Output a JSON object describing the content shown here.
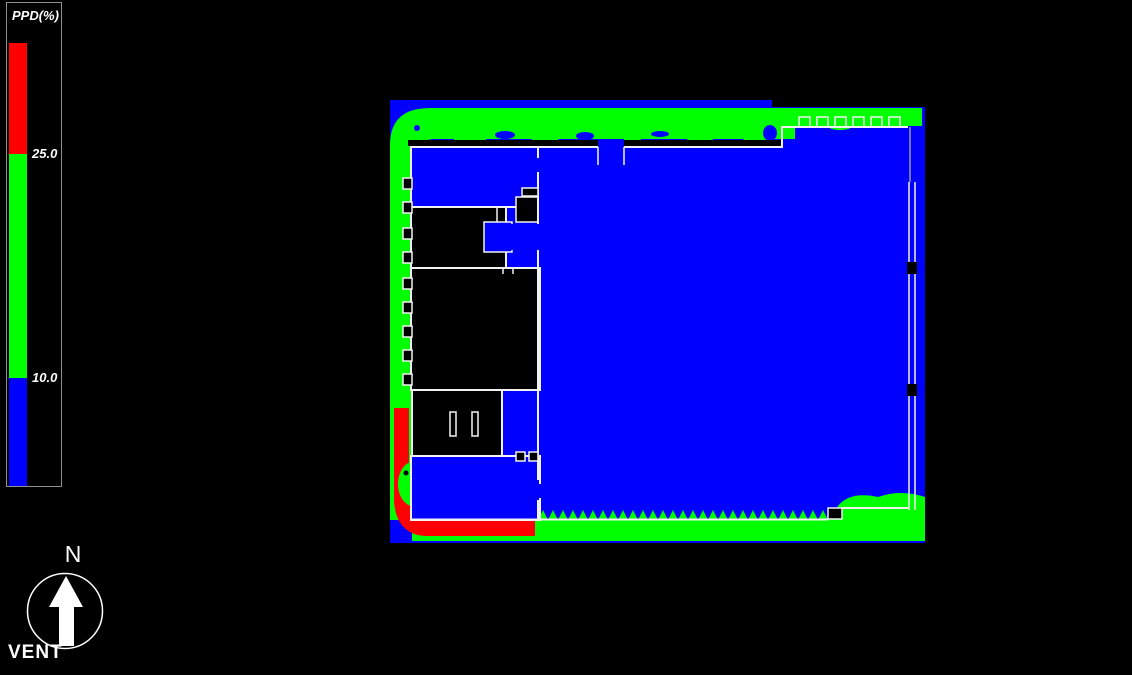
{
  "app": {
    "background_color": "#000000"
  },
  "legend": {
    "title": "PPD(%)",
    "units": "%",
    "ticks": [
      {
        "value": "25.0"
      },
      {
        "value": "10.0"
      }
    ],
    "bands": [
      {
        "name": "high",
        "color": "#ff0000",
        "range": "> 25.0"
      },
      {
        "name": "mid",
        "color": "#00ff00",
        "range": "10.0 - 25.0"
      },
      {
        "name": "low",
        "color": "#0000ff",
        "range": "< 10.0"
      }
    ]
  },
  "compass": {
    "north_label": "N",
    "caption": "VENT"
  },
  "chart_data": {
    "type": "heatmap",
    "title": "PPD(%)",
    "subtitle": "Predicted Percentage Dissatisfied contour map over building floor plan",
    "units": "%",
    "thresholds": [
      10.0,
      25.0
    ],
    "legend_entries": [
      {
        "color": "#ff0000",
        "range": "> 25.0"
      },
      {
        "color": "#00ff00",
        "range": "10.0 - 25.0"
      },
      {
        "color": "#0000ff",
        "range": "< 10.0"
      }
    ],
    "zones": [
      {
        "area": "main open interior space (east/centre)",
        "ppd": "< 10 (blue)"
      },
      {
        "area": "perimeter band along north wall, west wall and south wall",
        "ppd": "10 - 25 (green)"
      },
      {
        "area": "south-west corner and lower west wall strip",
        "ppd": "> 25 (red)"
      },
      {
        "area": "unconditioned rooms (west block interiors)",
        "ppd": "no data (black)"
      }
    ],
    "annotations": [
      "N (north arrow)",
      "VENT"
    ],
    "legend_position": "top-left",
    "grid": false
  },
  "colors": {
    "wall": "#f2f2f2",
    "background": "#000000",
    "text": "#ffffff"
  }
}
